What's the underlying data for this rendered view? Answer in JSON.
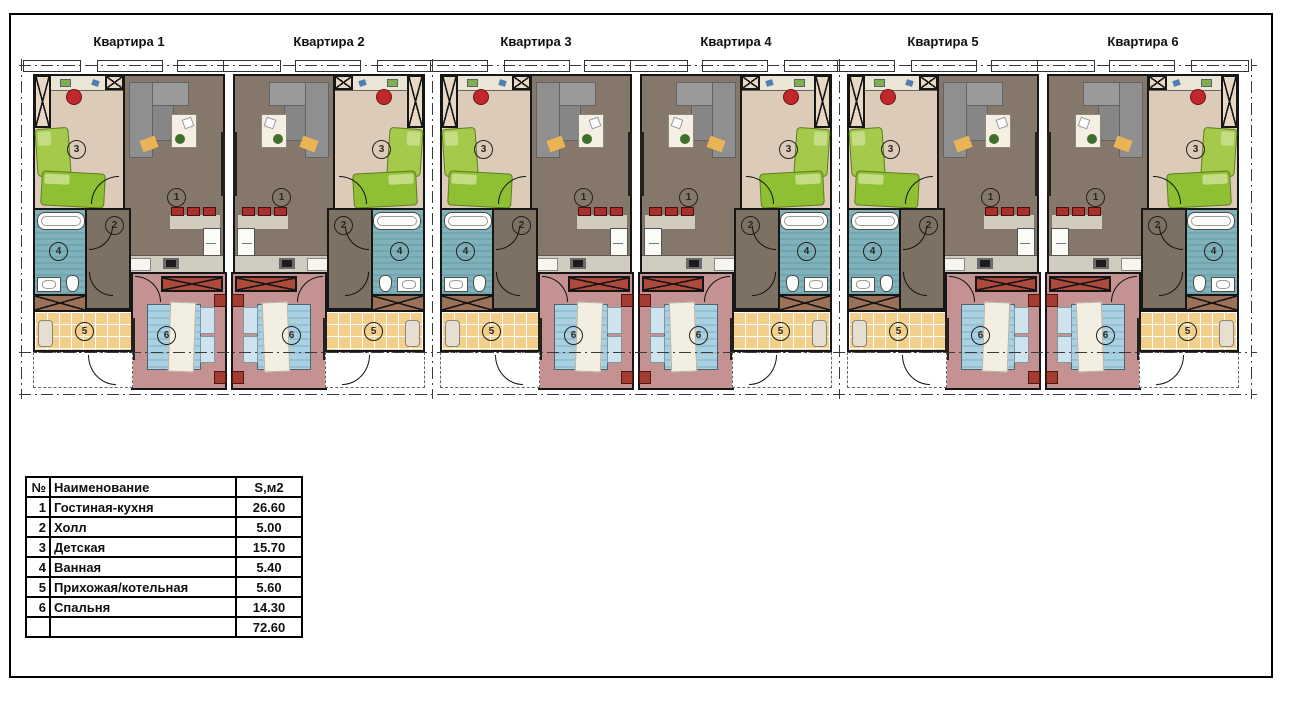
{
  "plan": {
    "apartments": [
      {
        "label": "Квартира 1",
        "mirrored": false
      },
      {
        "label": "Квартира 2",
        "mirrored": true
      },
      {
        "label": "Квартира 3",
        "mirrored": false
      },
      {
        "label": "Квартира 4",
        "mirrored": true
      },
      {
        "label": "Квартира 5",
        "mirrored": false
      },
      {
        "label": "Квартира 6",
        "mirrored": true
      }
    ],
    "room_numbers": {
      "living": "1",
      "hall": "2",
      "kids": "3",
      "bath": "4",
      "entry": "5",
      "bedroom": "6"
    },
    "colors": {
      "living_floor": "#85786a",
      "hall_floor": "#7d7164",
      "kids_floor": "#ddcbb9",
      "bath_floor": "#7fb2ba",
      "entry_floor": "#f2cf8a",
      "bedroom_floor": "#c59292",
      "wardrobe_red": "#ad4a3c",
      "wardrobe_brown": "#9b7257",
      "bed_green": "#a5c94a",
      "bed_blue": "#abd0e0",
      "chair_red": "#c1272d",
      "sofa_gray": "#9a9a9a"
    }
  },
  "legend": {
    "headers": {
      "num": "№",
      "name": "Наименование",
      "area": "S,м2"
    },
    "rows": [
      {
        "num": "1",
        "name": "Гостиная-кухня",
        "area": "26.60"
      },
      {
        "num": "2",
        "name": "Холл",
        "area": "5.00"
      },
      {
        "num": "3",
        "name": "Детская",
        "area": "15.70"
      },
      {
        "num": "4",
        "name": "Ванная",
        "area": "5.40"
      },
      {
        "num": "5",
        "name": "Прихожая/котельная",
        "area": "5.60"
      },
      {
        "num": "6",
        "name": "Спальня",
        "area": "14.30"
      }
    ],
    "total": "72.60"
  }
}
